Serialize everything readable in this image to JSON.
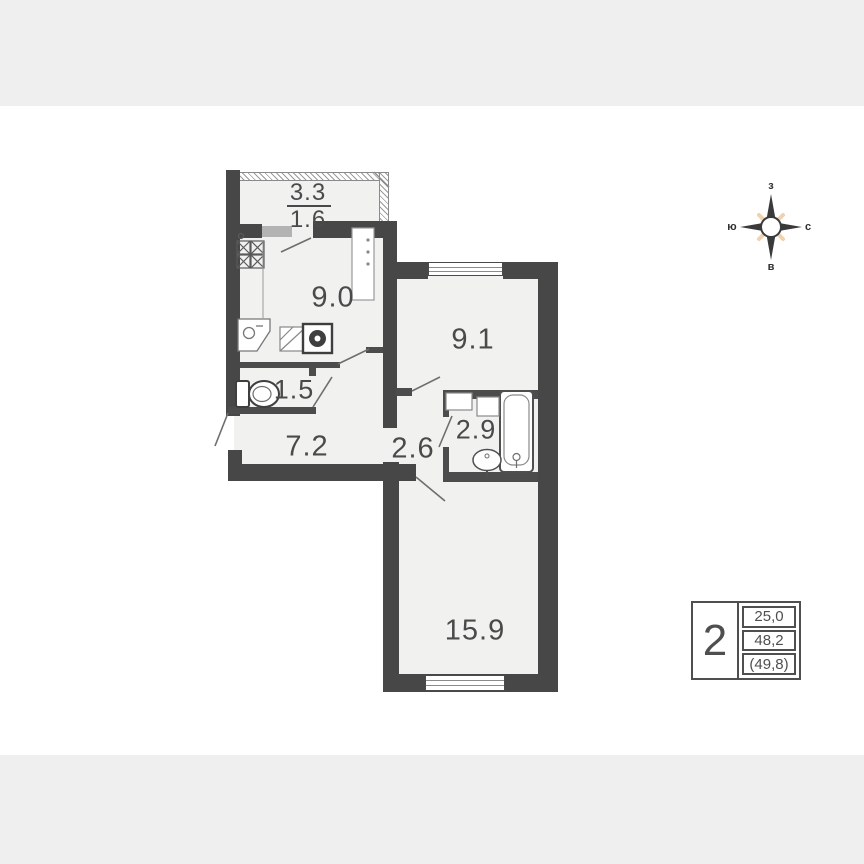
{
  "plan": {
    "rooms": [
      {
        "name": "kitchen",
        "area": "9.0"
      },
      {
        "name": "bedroom",
        "area": "9.1"
      },
      {
        "name": "wc",
        "area": "1.5"
      },
      {
        "name": "hallway",
        "area": "7.2"
      },
      {
        "name": "corridor",
        "area": "2.6"
      },
      {
        "name": "bathroom",
        "area": "2.9"
      },
      {
        "name": "living-room",
        "area": "15.9"
      }
    ],
    "balcony": {
      "area_full": "3.3",
      "area_reduced": "1.6"
    }
  },
  "compass": {
    "top": "з",
    "left": "ю",
    "right": "с",
    "bottom": "в"
  },
  "info_table": {
    "rooms_count": "2",
    "row_top": "25,0",
    "row_middle": "48,2",
    "row_bottom": "(49,8)"
  },
  "colors": {
    "wall": "#474747",
    "floor": "#f1f1f0",
    "page_band": "#efefef",
    "label_text": "#4a4a4a",
    "compass_ray": "#f0d2ae",
    "window_sill": "#b3b3b3"
  }
}
